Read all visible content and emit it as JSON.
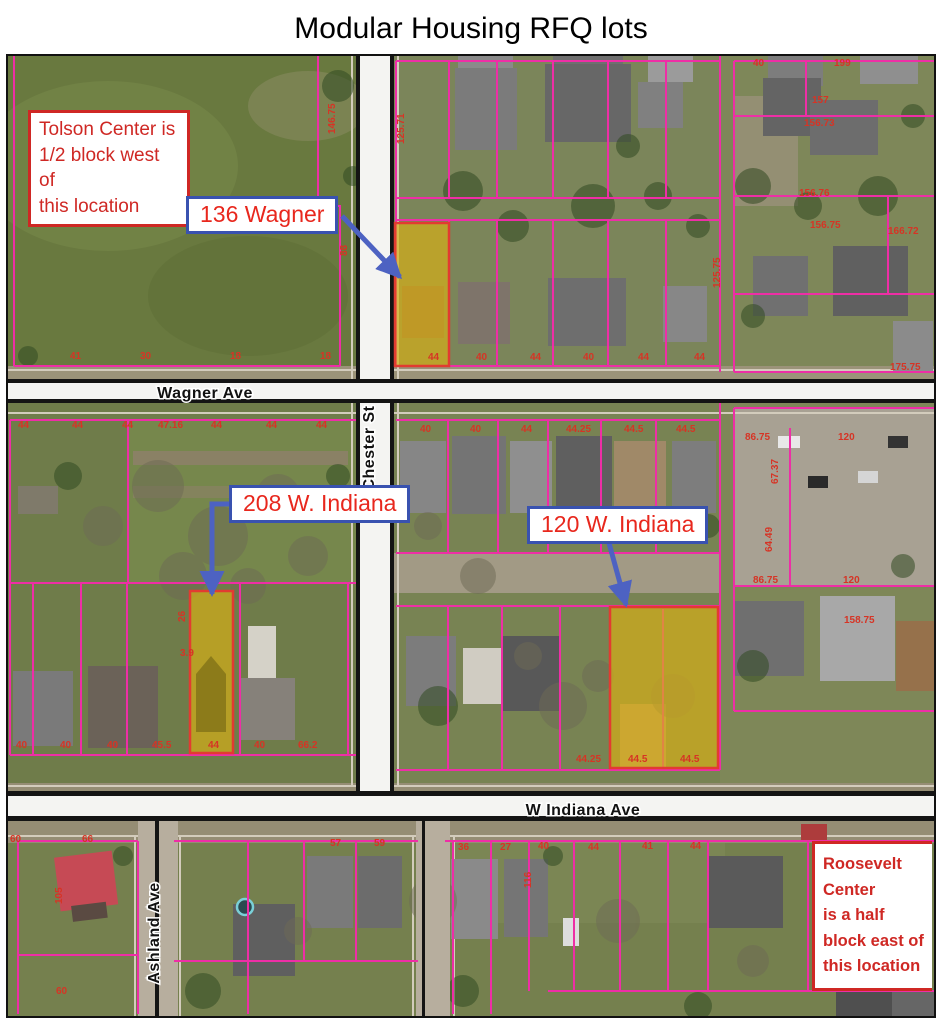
{
  "title": "Modular Housing RFQ lots",
  "callouts": {
    "tolson": "Tolson Center is\n1/2 block west of\nthis location",
    "roosevelt": "Roosevelt Center\nis a half\nblock east of\nthis location"
  },
  "lot_labels": {
    "wagner_136": "136 Wagner",
    "indiana_208": "208 W. Indiana",
    "indiana_120": "120 W. Indiana"
  },
  "streets": {
    "wagner": "Wagner Ave",
    "chester": "Chester St",
    "indiana": "W Indiana Ave",
    "ashland": "Ashland Ave"
  },
  "colors": {
    "parcel_line": "#ee2ea6",
    "highlight_fill": "#d9af16",
    "highlight_stroke": "#e23b31",
    "label_border": "#3952b0",
    "label_text": "#e8271d",
    "arrow": "#4d62c2",
    "callout": "#cf2824",
    "dimension_text": "#d63425",
    "road_label": "#111111"
  },
  "parcel_numbers": [
    {
      "x": 62,
      "y": 303,
      "t": "41"
    },
    {
      "x": 132,
      "y": 303,
      "t": "30"
    },
    {
      "x": 222,
      "y": 303,
      "t": "18"
    },
    {
      "x": 312,
      "y": 303,
      "t": "18"
    },
    {
      "x": 327,
      "y": 78,
      "t": "146.75",
      "r": -90
    },
    {
      "x": 396,
      "y": 88,
      "t": "125.71",
      "r": -90
    },
    {
      "x": 339,
      "y": 200,
      "t": "88",
      "r": -90
    },
    {
      "x": 420,
      "y": 304,
      "t": "44"
    },
    {
      "x": 468,
      "y": 304,
      "t": "40"
    },
    {
      "x": 522,
      "y": 304,
      "t": "44"
    },
    {
      "x": 575,
      "y": 304,
      "t": "40"
    },
    {
      "x": 630,
      "y": 304,
      "t": "44"
    },
    {
      "x": 686,
      "y": 304,
      "t": "44"
    },
    {
      "x": 712,
      "y": 232,
      "t": "125.75",
      "r": -90
    },
    {
      "x": 745,
      "y": 10,
      "t": "40"
    },
    {
      "x": 826,
      "y": 10,
      "t": "199"
    },
    {
      "x": 804,
      "y": 47,
      "t": "157"
    },
    {
      "x": 796,
      "y": 70,
      "t": "156.73"
    },
    {
      "x": 791,
      "y": 140,
      "t": "156.76"
    },
    {
      "x": 802,
      "y": 172,
      "t": "156.75"
    },
    {
      "x": 880,
      "y": 178,
      "t": "166.72"
    },
    {
      "x": 882,
      "y": 314,
      "t": "175.75"
    },
    {
      "x": 10,
      "y": 372,
      "t": "44"
    },
    {
      "x": 64,
      "y": 372,
      "t": "44"
    },
    {
      "x": 114,
      "y": 372,
      "t": "44"
    },
    {
      "x": 150,
      "y": 372,
      "t": "47.16"
    },
    {
      "x": 203,
      "y": 372,
      "t": "44"
    },
    {
      "x": 258,
      "y": 372,
      "t": "44"
    },
    {
      "x": 308,
      "y": 372,
      "t": "44"
    },
    {
      "x": 8,
      "y": 692,
      "t": "40"
    },
    {
      "x": 52,
      "y": 692,
      "t": "40"
    },
    {
      "x": 99,
      "y": 692,
      "t": "40"
    },
    {
      "x": 144,
      "y": 692,
      "t": "45.5"
    },
    {
      "x": 200,
      "y": 692,
      "t": "44"
    },
    {
      "x": 246,
      "y": 692,
      "t": "40"
    },
    {
      "x": 290,
      "y": 692,
      "t": "66.2"
    },
    {
      "x": 172,
      "y": 600,
      "t": "3.9"
    },
    {
      "x": 177,
      "y": 566,
      "t": "26",
      "r": -90
    },
    {
      "x": 412,
      "y": 376,
      "t": "40"
    },
    {
      "x": 462,
      "y": 376,
      "t": "40"
    },
    {
      "x": 513,
      "y": 376,
      "t": "44"
    },
    {
      "x": 558,
      "y": 376,
      "t": "44.25"
    },
    {
      "x": 616,
      "y": 376,
      "t": "44.5"
    },
    {
      "x": 668,
      "y": 376,
      "t": "44.5"
    },
    {
      "x": 394,
      "y": 447,
      "t": "132",
      "r": -90
    },
    {
      "x": 568,
      "y": 706,
      "t": "44.25"
    },
    {
      "x": 620,
      "y": 706,
      "t": "44.5"
    },
    {
      "x": 672,
      "y": 706,
      "t": "44.5"
    },
    {
      "x": 737,
      "y": 384,
      "t": "86.75"
    },
    {
      "x": 830,
      "y": 384,
      "t": "120"
    },
    {
      "x": 770,
      "y": 428,
      "t": "67.37",
      "r": -90
    },
    {
      "x": 764,
      "y": 496,
      "t": "64.49",
      "r": -90
    },
    {
      "x": 745,
      "y": 527,
      "t": "86.75"
    },
    {
      "x": 835,
      "y": 527,
      "t": "120"
    },
    {
      "x": 836,
      "y": 567,
      "t": "158.75"
    },
    {
      "x": 2,
      "y": 786,
      "t": "60"
    },
    {
      "x": 74,
      "y": 786,
      "t": "66"
    },
    {
      "x": 54,
      "y": 848,
      "t": "105",
      "r": -90
    },
    {
      "x": 48,
      "y": 938,
      "t": "60"
    },
    {
      "x": 322,
      "y": 790,
      "t": "57"
    },
    {
      "x": 366,
      "y": 790,
      "t": "59"
    },
    {
      "x": 450,
      "y": 794,
      "t": "36"
    },
    {
      "x": 492,
      "y": 794,
      "t": "27"
    },
    {
      "x": 530,
      "y": 793,
      "t": "40"
    },
    {
      "x": 580,
      "y": 794,
      "t": "44"
    },
    {
      "x": 634,
      "y": 793,
      "t": "41"
    },
    {
      "x": 682,
      "y": 793,
      "t": "44"
    },
    {
      "x": 523,
      "y": 832,
      "t": "116",
      "r": -90
    }
  ]
}
